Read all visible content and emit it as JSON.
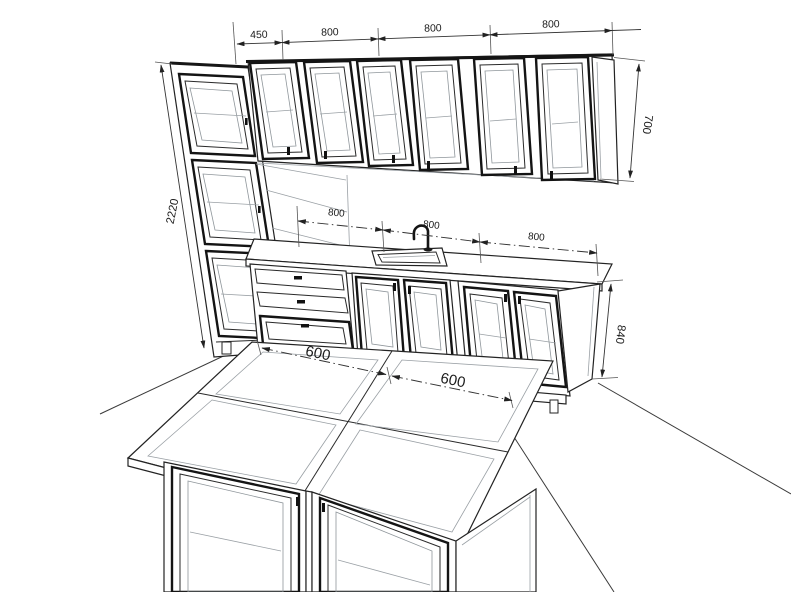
{
  "meta": {
    "subject": "kitchen cabinetry 3D dimension line drawing",
    "units": "mm"
  },
  "palette": {
    "background": "#ffffff",
    "line": "#232323",
    "light_line": "#9aa0a5",
    "dimension_line": "#333333",
    "text": "#1c1c1c"
  },
  "dimensions": {
    "top_chain": [
      "450",
      "800",
      "800",
      "800"
    ],
    "tall_height": "2220",
    "upper_height": "700",
    "counter_chain": [
      "800",
      "800",
      "800"
    ],
    "base_height": "840",
    "island_chain": [
      "600",
      "600"
    ]
  }
}
